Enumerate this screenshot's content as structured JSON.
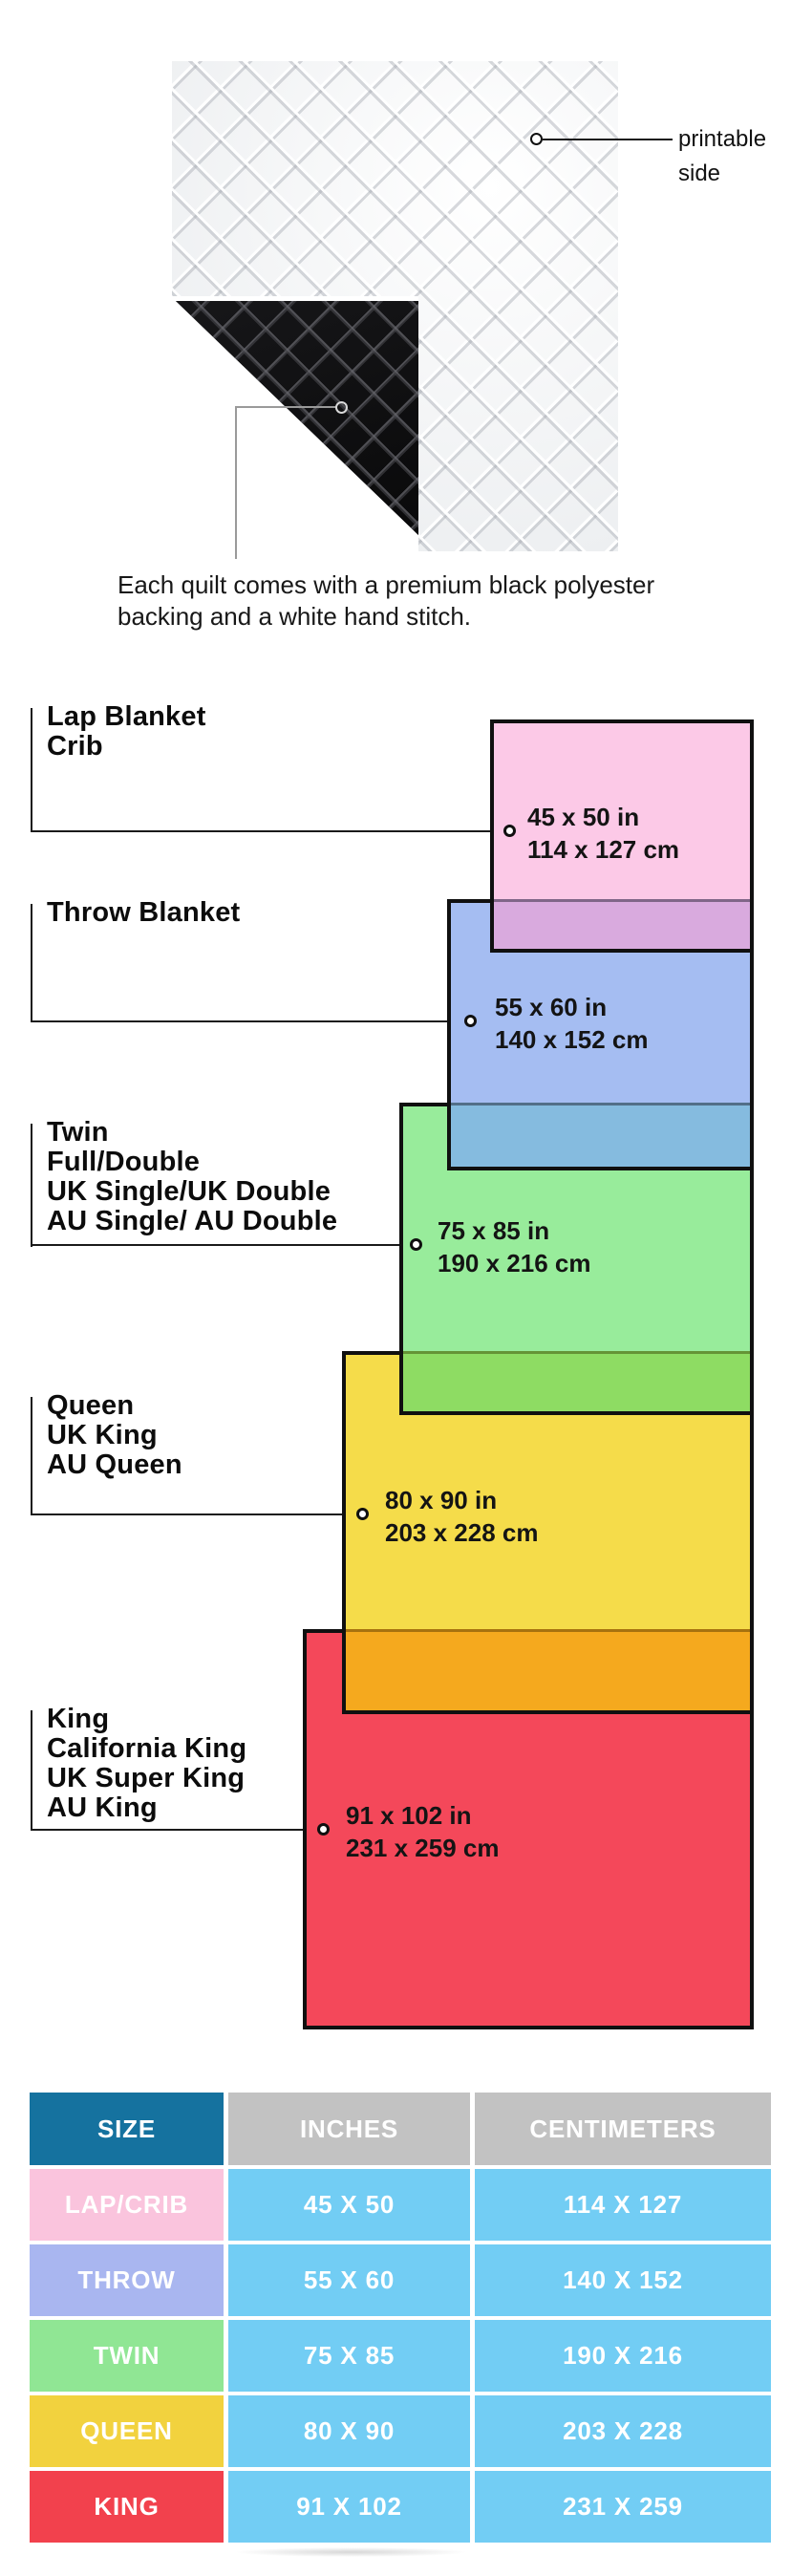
{
  "hero": {
    "printable_label_line1": "printable",
    "printable_label_line2": "side",
    "caption_line1": "Each quilt comes with a premium black polyester",
    "caption_line2": "backing and a white hand stitch.",
    "quilt_front_color": "#f0f0f2",
    "backing_color": "#161616"
  },
  "diagram": {
    "items": [
      {
        "id": "lap-crib",
        "label_lines": [
          "Lap Blanket",
          "Crib"
        ],
        "inches": "45 x 50 in",
        "cm": "114 x 127 cm",
        "fill": "#fcc9e7"
      },
      {
        "id": "throw",
        "label_lines": [
          "Throw Blanket"
        ],
        "inches": "55 x 60 in",
        "cm": "140 x 152 cm",
        "fill": "#a5bdf2"
      },
      {
        "id": "twin",
        "label_lines": [
          "Twin",
          "Full/Double",
          "UK Single/UK Double",
          "AU Single/ AU Double"
        ],
        "inches": "75 x 85 in",
        "cm": "190 x 216 cm",
        "fill": "#98ec9b"
      },
      {
        "id": "queen",
        "label_lines": [
          "Queen",
          "UK King",
          "AU Queen"
        ],
        "inches": "80 x 90 in",
        "cm": "203 x 228 cm",
        "fill": "#f5dc4a"
      },
      {
        "id": "king",
        "label_lines": [
          "King",
          "California King",
          "UK Super King",
          "AU King"
        ],
        "inches": "91 x 102 in",
        "cm": "231 x 259 cm",
        "fill": "#f4485a"
      }
    ],
    "overlap_colors": {
      "pink_over_blue": "#d9aade",
      "blue_over_green": "#85bbdf",
      "green_over_yellow": "#8edc63",
      "yellow_over_red": "#f5a91e"
    },
    "outline_color": "#101010"
  },
  "table": {
    "headers": [
      "SIZE",
      "INCHES",
      "CENTIMETERS"
    ],
    "header_colors": {
      "size": "#15729f",
      "measure": "#c2c2c2"
    },
    "value_cell_color": "#72cdf4",
    "rows": [
      {
        "size": "LAP/CRIB",
        "inches": "45 X 50",
        "cm": "114 X 127",
        "color": "#fac4dd"
      },
      {
        "size": "THROW",
        "inches": "55 X 60",
        "cm": "140 X 152",
        "color": "#a9b6f0"
      },
      {
        "size": "TWIN",
        "inches": "75 X 85",
        "cm": "190 X 216",
        "color": "#90e694"
      },
      {
        "size": "QUEEN",
        "inches": "80 X 90",
        "cm": "203 X 228",
        "color": "#f2d23e"
      },
      {
        "size": "KING",
        "inches": "91 X 102",
        "cm": "231 X 259",
        "color": "#f2414d"
      }
    ]
  }
}
